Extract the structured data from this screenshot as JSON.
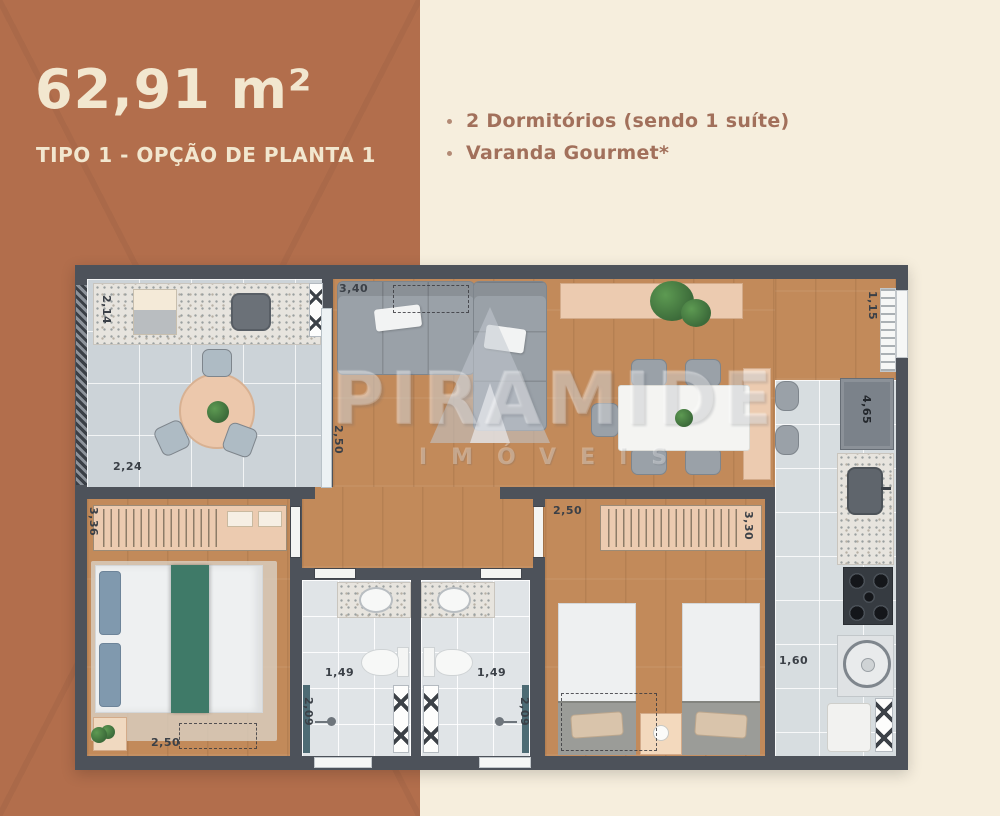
{
  "header": {
    "area_value": "62,91 m²",
    "plan_label": "TIPO 1 - OPÇÃO DE PLANTA 1"
  },
  "features": {
    "items": [
      {
        "label": "2 Dormitórios (sendo 1 suíte)"
      },
      {
        "label": "Varanda Gourmet*"
      }
    ]
  },
  "watermark": {
    "brand": "PIRAMIDE",
    "tagline": "IMÓVEIS"
  },
  "plan_dimensions": {
    "varanda_depth": "2,14",
    "varanda_width": "2,24",
    "living_width": "3,40",
    "living_depth": "2,50",
    "entry_wall": "1,15",
    "kitchen_length": "4,65",
    "kitchen_width": "1,60",
    "bedroom2_door_width": "2,50",
    "bedroom2_length": "3,30",
    "suite_length": "3,36",
    "suite_width": "2,50",
    "bath1_width": "1,49",
    "bath2_width": "1,49",
    "bath1_depth": "2,09",
    "bath2_depth": "2,09"
  },
  "colors": {
    "terracotta": "#b26e4c",
    "cream": "#f6eedd",
    "title_text": "#f2e7cf",
    "feature_text": "#a2705b",
    "wall": "#4d525a",
    "wood": "#c28a5a",
    "tile": "#ccd3d8",
    "bath_tile": "#e0e4e7",
    "granite": "#e7e4de",
    "furniture_gray": "#9aa1a8",
    "tan": "#eccbb0",
    "green": "#3f7a68",
    "dim_text": "#3b4047"
  }
}
